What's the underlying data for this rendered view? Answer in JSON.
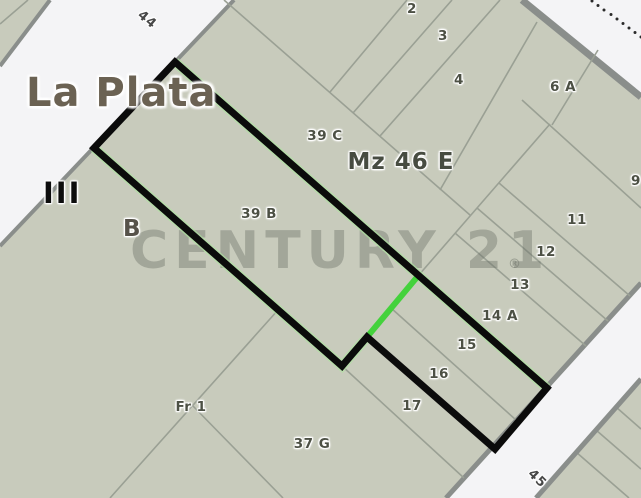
{
  "map": {
    "city_label": "La Plata",
    "district_label": "III",
    "section_label": "B",
    "block_label": "Mz 46 E",
    "street_upper_label": "44",
    "street_lower_label": "45",
    "watermark": {
      "text": "CENTURY 21",
      "reg": "®"
    },
    "parcels": [
      {
        "id": "2",
        "x": 412,
        "y": 9
      },
      {
        "id": "3",
        "x": 443,
        "y": 36
      },
      {
        "id": "4",
        "x": 459,
        "y": 80
      },
      {
        "id": "6 A",
        "x": 563,
        "y": 87
      },
      {
        "id": "9",
        "x": 636,
        "y": 181
      },
      {
        "id": "11",
        "x": 577,
        "y": 220
      },
      {
        "id": "12",
        "x": 546,
        "y": 252
      },
      {
        "id": "13",
        "x": 520,
        "y": 285
      },
      {
        "id": "14 A",
        "x": 500,
        "y": 316
      },
      {
        "id": "15",
        "x": 467,
        "y": 345
      },
      {
        "id": "16",
        "x": 439,
        "y": 374
      },
      {
        "id": "17",
        "x": 412,
        "y": 406
      },
      {
        "id": "39 C",
        "x": 325,
        "y": 136
      },
      {
        "id": "39 B",
        "x": 259,
        "y": 214
      },
      {
        "id": "Fr 1",
        "x": 191,
        "y": 407
      },
      {
        "id": "37 G",
        "x": 312,
        "y": 444
      }
    ],
    "colors": {
      "street_fill": "#f4f4f6",
      "parcel_fill": "#c8cbbc",
      "street_border": "#8a8e8b",
      "parcel_line": "#9aa094",
      "label_color": "#4c5044",
      "property_outline": "#0b0b0b",
      "divider_green": "#44d23c",
      "outline_glow_green": "#aee3a0",
      "watermark_gray": "#6f746a"
    }
  }
}
